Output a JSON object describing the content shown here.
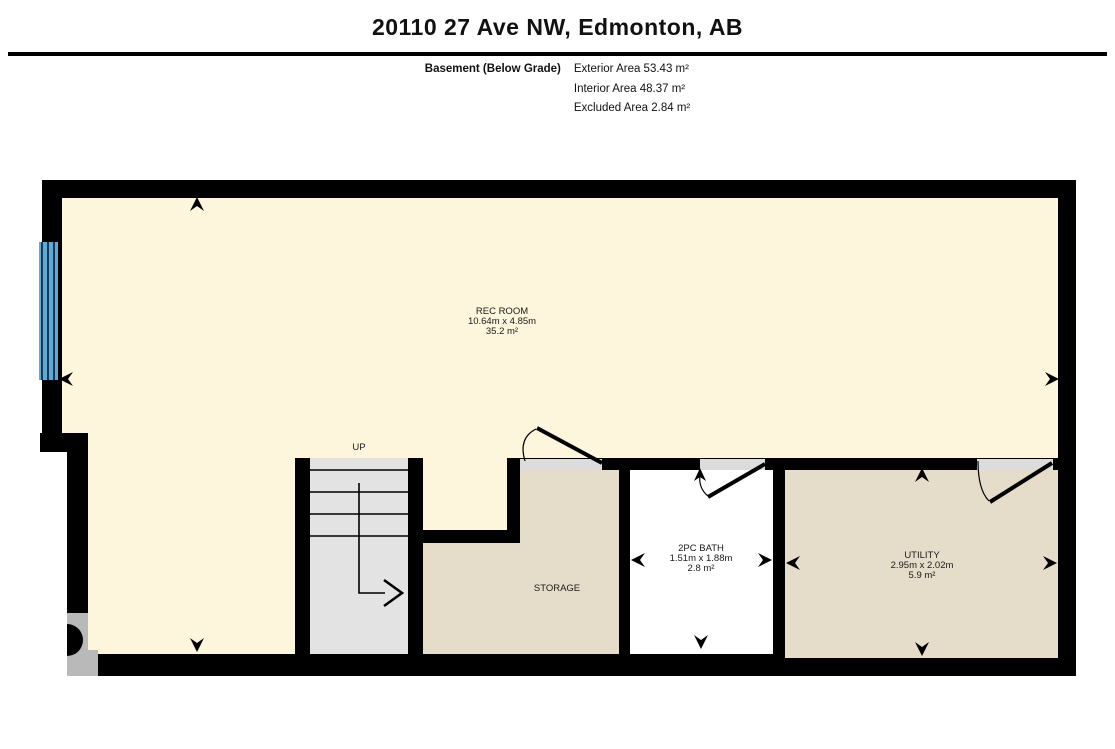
{
  "header": {
    "title": "20110 27 Ave NW, Edmonton, AB",
    "floor_label": "Basement (Below Grade)",
    "areas": {
      "exterior": "Exterior Area 53.43 m²",
      "interior": "Interior Area 48.37 m²",
      "excluded": "Excluded Area 2.84 m²"
    }
  },
  "rooms": {
    "rec": {
      "name": "REC ROOM",
      "dims": "10.64m x 4.85m",
      "area": "35.2 m²"
    },
    "storage": {
      "name": "STORAGE"
    },
    "bath": {
      "name": "2PC BATH",
      "dims": "1.51m x 1.88m",
      "area": "2.8 m²"
    },
    "utility": {
      "name": "UTILITY",
      "dims": "2.95m x 2.02m",
      "area": "5.9 m²"
    },
    "stairs": {
      "label": "UP"
    }
  },
  "colors": {
    "wall_black": "#000000",
    "floor_cream": "#fdf5dc",
    "floor_tan": "#e5dcca",
    "bath_white": "#ffffff",
    "stairs_gray": "#e3e3e3",
    "opening_gray": "#dcdcdc",
    "block_gray": "#b9b9b9",
    "window_blue": "#62a9d1",
    "window_line": "#17395c"
  }
}
